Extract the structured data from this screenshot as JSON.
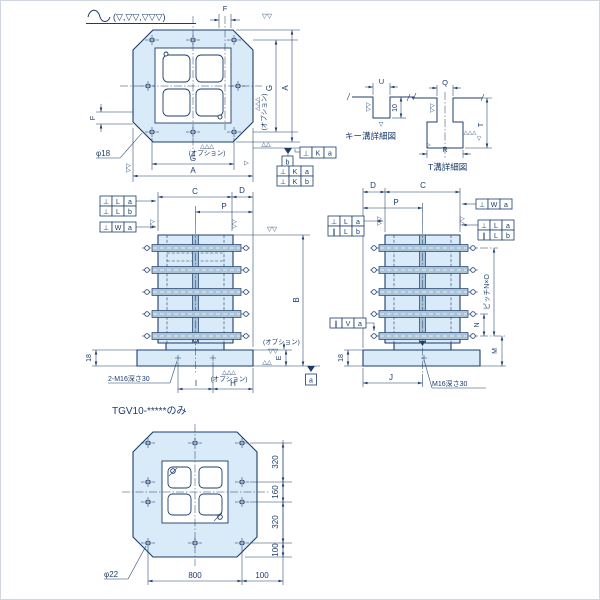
{
  "d": {
    "legend": "(▽,▽▽,▽▽▽)",
    "marks": {
      "v1": "▽",
      "v2": "▽▽",
      "u2": "△△",
      "u3": "△△△",
      "opt": "(オプション)"
    },
    "tv": {
      "F": "F",
      "G": "G",
      "A": "A",
      "dia": "φ18"
    },
    "kd": {
      "title": "キー溝詳細図",
      "U": "U",
      "d10": "10"
    },
    "td": {
      "title": "T溝詳細図",
      "Q": "Q",
      "T": "T",
      "R": "R"
    },
    "fv": {
      "C": "C",
      "D": "D",
      "P": "P",
      "B": "B",
      "E": "E",
      "t18": "18",
      "I": "I",
      "H": "H",
      "tap": "2-M16深さ30"
    },
    "sv": {
      "D": "D",
      "C": "C",
      "P": "P",
      "N": "N",
      "M": "M",
      "J": "J",
      "t18": "18",
      "tap": "M16深さ30",
      "pitch": "ピッチN×O"
    },
    "bv": {
      "title": "TGV10-*****のみ",
      "a320": "320",
      "a160": "160",
      "b320": "320",
      "r100": "100",
      "w800": "800",
      "b100": "100",
      "dia": "φ22"
    },
    "fr": {
      "perp": "⊥",
      "par": "∥",
      "K": "K",
      "L": "L",
      "W": "W",
      "V": "V",
      "a": "a",
      "b": "b"
    }
  }
}
